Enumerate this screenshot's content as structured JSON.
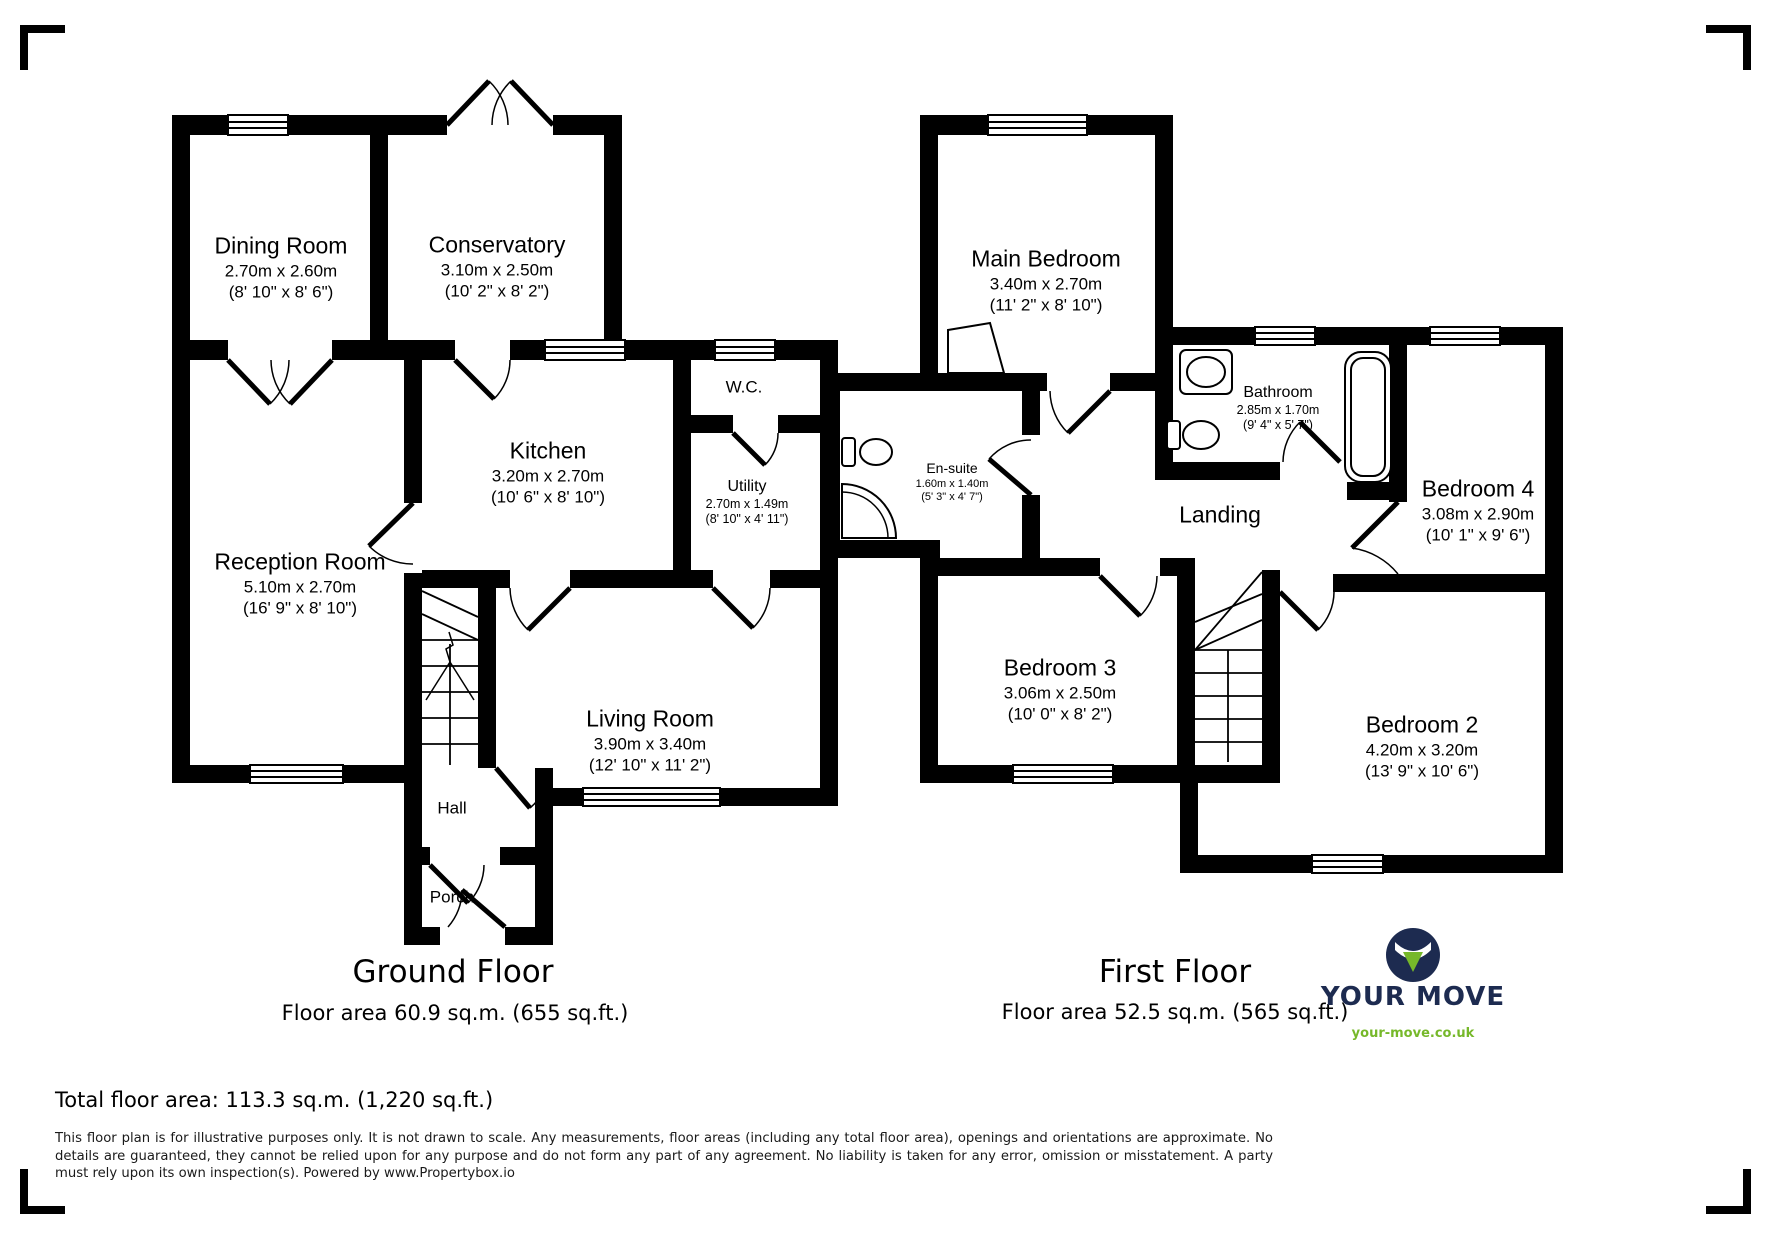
{
  "ground_floor": {
    "title": "Ground Floor",
    "area_label": "Floor area 60.9 sq.m. (655 sq.ft.)",
    "rooms": {
      "dining": {
        "name": "Dining Room",
        "metric": "2.70m x 2.60m",
        "imperial": "(8' 10\" x 8' 6\")"
      },
      "conservatory": {
        "name": "Conservatory",
        "metric": "3.10m x 2.50m",
        "imperial": "(10' 2\" x 8' 2\")"
      },
      "kitchen": {
        "name": "Kitchen",
        "metric": "3.20m x 2.70m",
        "imperial": "(10' 6\" x 8' 10\")"
      },
      "wc": {
        "name": "W.C."
      },
      "utility": {
        "name": "Utility",
        "metric": "2.70m x 1.49m",
        "imperial": "(8' 10\" x 4' 11\")"
      },
      "reception": {
        "name": "Reception Room",
        "metric": "5.10m x 2.70m",
        "imperial": "(16' 9\" x 8' 10\")"
      },
      "living": {
        "name": "Living Room",
        "metric": "3.90m x 3.40m",
        "imperial": "(12' 10\" x 11' 2\")"
      },
      "hall": {
        "name": "Hall"
      },
      "porch": {
        "name": "Porch"
      }
    }
  },
  "first_floor": {
    "title": "First Floor",
    "area_label": "Floor area 52.5 sq.m. (565 sq.ft.)",
    "rooms": {
      "main_bedroom": {
        "name": "Main Bedroom",
        "metric": "3.40m x 2.70m",
        "imperial": "(11' 2\" x 8' 10\")"
      },
      "ensuite": {
        "name": "En-suite",
        "metric": "1.60m x 1.40m",
        "imperial": "(5' 3\" x 4' 7\")"
      },
      "bathroom": {
        "name": "Bathroom",
        "metric": "2.85m x 1.70m",
        "imperial": "(9' 4\" x 5' 7\")"
      },
      "bedroom4": {
        "name": "Bedroom 4",
        "metric": "3.08m x 2.90m",
        "imperial": "(10' 1\" x 9' 6\")"
      },
      "landing": {
        "name": "Landing"
      },
      "bedroom3": {
        "name": "Bedroom 3",
        "metric": "3.06m x 2.50m",
        "imperial": "(10' 0\" x 8' 2\")"
      },
      "bedroom2": {
        "name": "Bedroom 2",
        "metric": "4.20m x 3.20m",
        "imperial": "(13' 9\" x 10' 6\")"
      }
    }
  },
  "footer": {
    "total_area": "Total floor area: 113.3 sq.m. (1,220 sq.ft.)",
    "disclaimer": "This floor plan is for illustrative purposes only. It is not drawn to scale. Any measurements, floor areas (including any total floor area), openings and orientations are approximate. No details are guaranteed, they cannot be relied upon for any purpose and do not form any part of any agreement. No liability is taken for any error, omission or misstatement. A party must rely upon its own inspection(s). Powered by www.Propertybox.io"
  },
  "logo": {
    "brand": "YOUR MOVE",
    "website": "your-move.co.uk",
    "brand_color": "#1d2b50",
    "accent_color": "#76b82a"
  }
}
